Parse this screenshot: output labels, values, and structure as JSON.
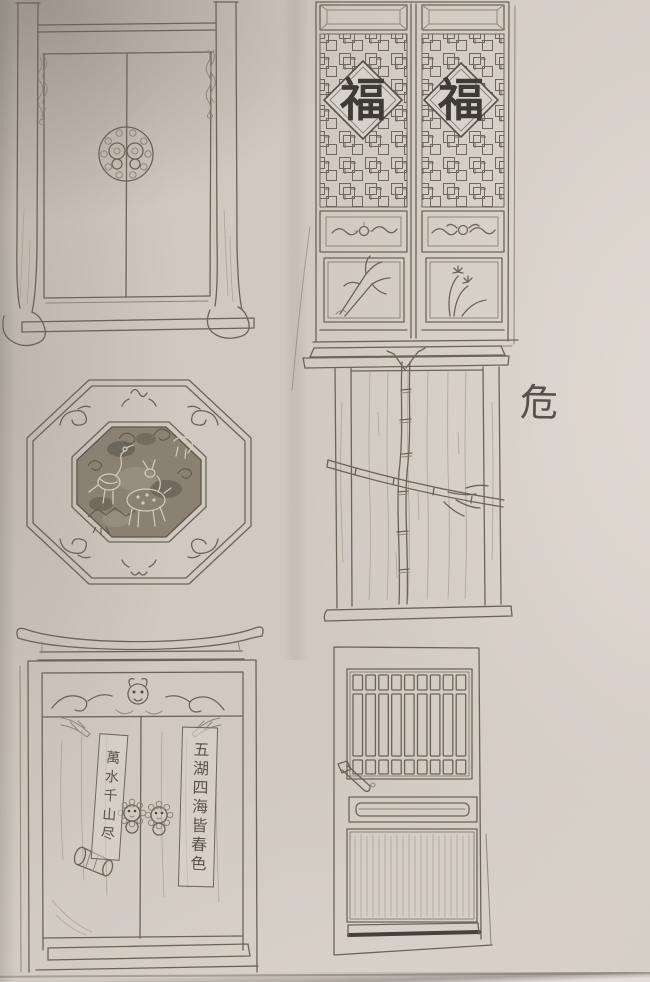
{
  "colors": {
    "paper": "#cfc9c0",
    "paper_shadow": "#aba59b",
    "pencil_light": "#8e867a",
    "pencil": "#6b6459",
    "pencil_dark": "#4d4740",
    "ink": "#56514b",
    "carving_background": "#8a8173"
  },
  "inscriptions": {
    "fu_left": "福",
    "fu_right": "福",
    "couplet_right": "五湖四海皆春色",
    "couplet_left": "萬水千山尽",
    "margin_character": "危"
  }
}
